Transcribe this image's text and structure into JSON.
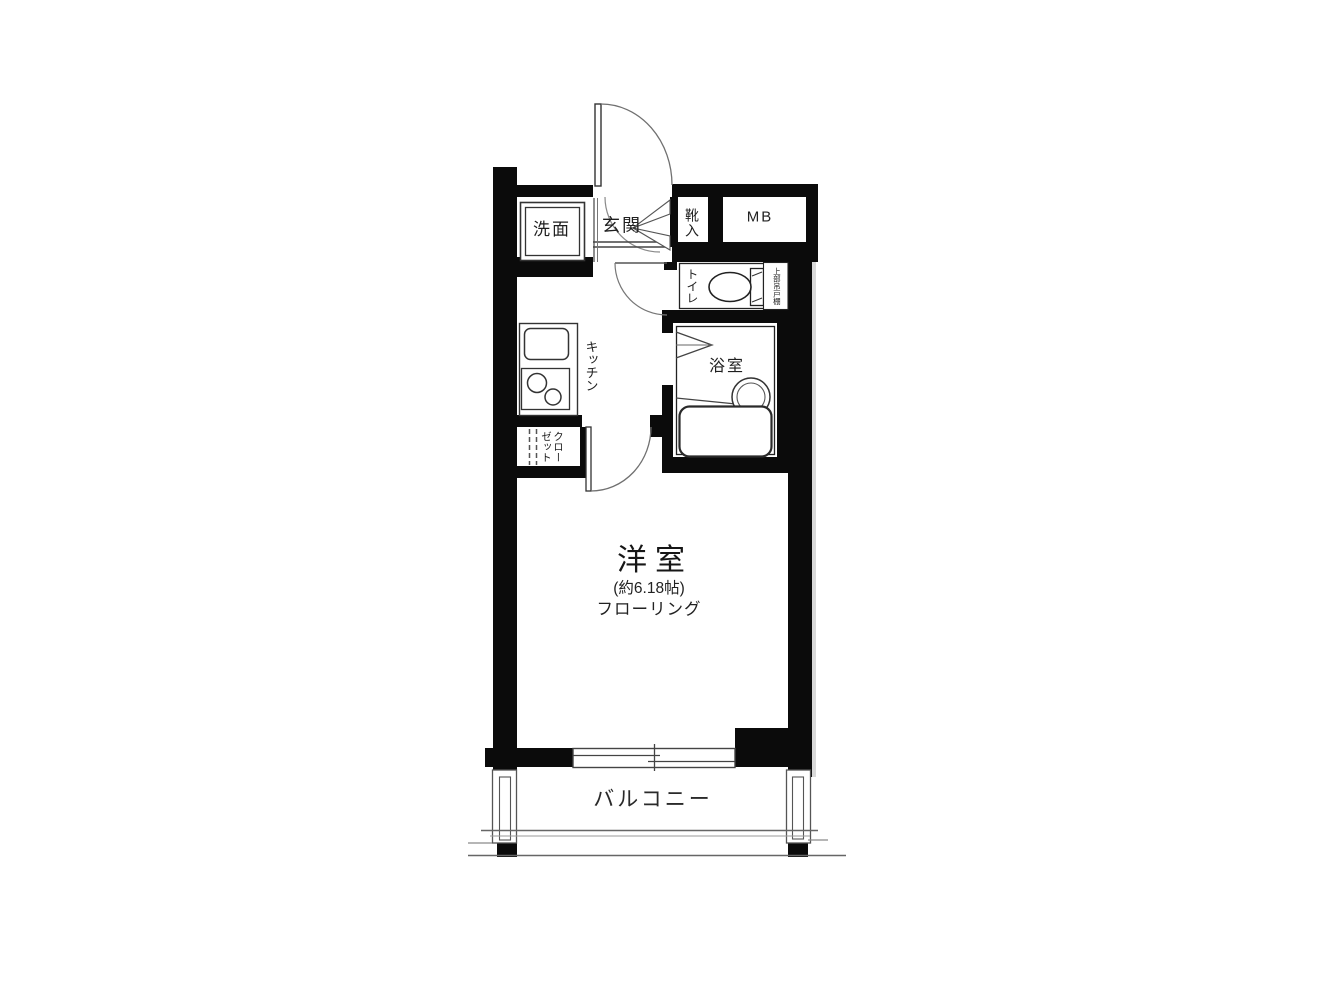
{
  "colors": {
    "wall": "#0b0b0b",
    "thin_line": "#444444",
    "arc_line": "#777777",
    "background": "#ffffff"
  },
  "rooms": {
    "washroom": {
      "label": "洗面"
    },
    "entrance": {
      "label": "玄関"
    },
    "shoe_cabinet": {
      "label": "靴入"
    },
    "meter_box": {
      "label": "MB"
    },
    "toilet": {
      "label": "トイレ",
      "shelf_note": "上部吊戸棚"
    },
    "kitchen": {
      "label": "キッチン"
    },
    "closet": {
      "label": "クローゼット"
    },
    "bathroom": {
      "label": "浴室"
    },
    "main_room": {
      "label": "洋室",
      "area": "(約6.18帖)",
      "flooring": "フローリング"
    },
    "balcony": {
      "label": "バルコニー"
    }
  }
}
